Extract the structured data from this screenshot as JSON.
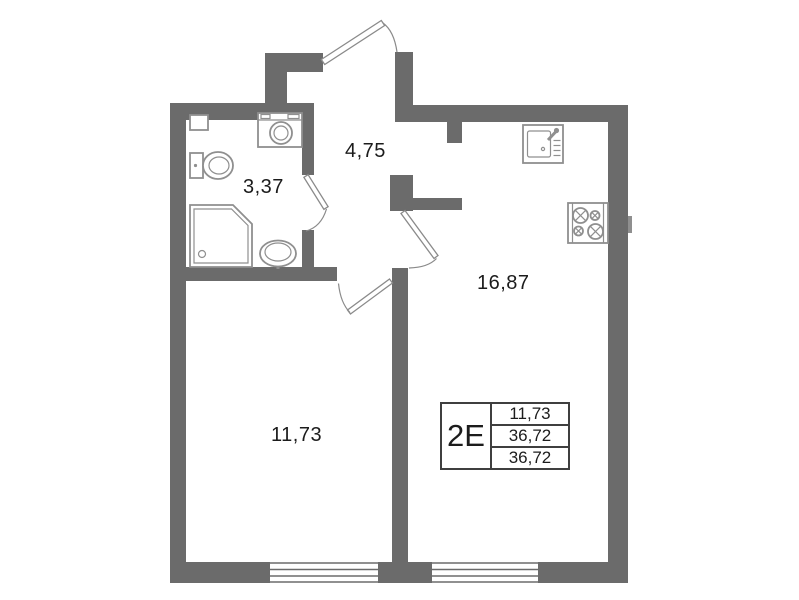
{
  "colors": {
    "wall": "#6b6b6b",
    "fixture": "#8f8f8f",
    "door": "#8a8a8a",
    "line": "#3f3f3f",
    "text": "#1c1c1c",
    "background": "#ffffff"
  },
  "rooms": {
    "bathroom": {
      "area": "3,37"
    },
    "hall": {
      "area": "4,75"
    },
    "kitchen": {
      "area": "16,87"
    },
    "living": {
      "area": "11,73"
    }
  },
  "legend": {
    "unit_type": "2Е",
    "rows": [
      "11,73",
      "36,72",
      "36,72"
    ]
  },
  "fixtures": [
    "vent-box",
    "washing-machine",
    "toilet",
    "shower",
    "bathroom-sink",
    "kitchen-sink",
    "stove"
  ]
}
